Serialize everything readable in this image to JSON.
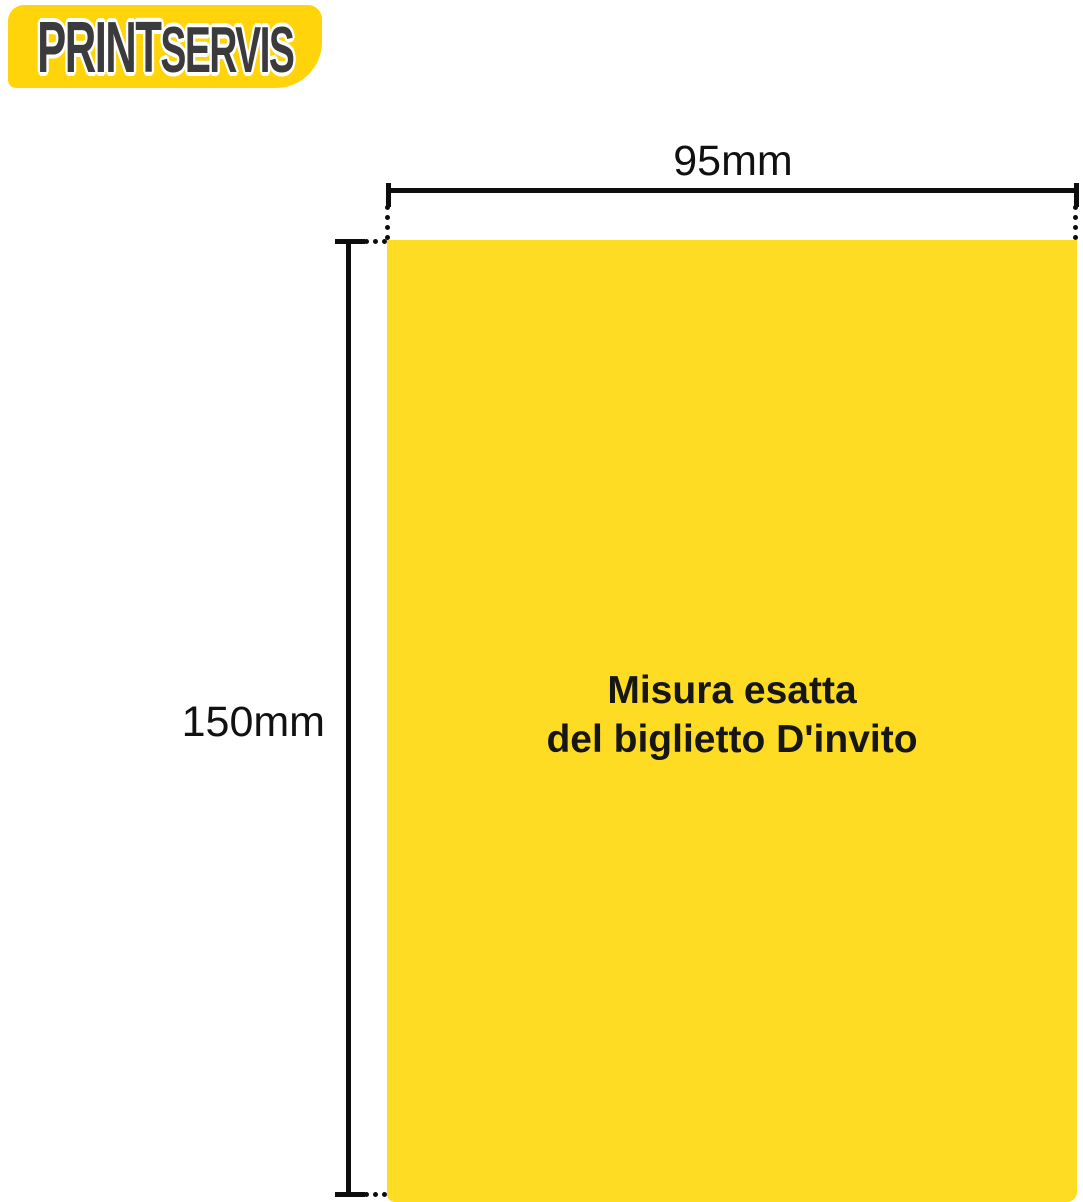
{
  "logo": {
    "text_primary": "PRINT",
    "text_secondary": "SERVIS",
    "background_color": "#FFD40A",
    "letter_color": "#3B3B3D"
  },
  "diagram": {
    "width_label": "95mm",
    "height_label": "150mm",
    "line_color": "#0D0D0D"
  },
  "card": {
    "caption_line1": "Misura esatta",
    "caption_line2": "del biglietto D'invito",
    "fill_color": "#FEDC24",
    "caption_color": "#161616"
  }
}
